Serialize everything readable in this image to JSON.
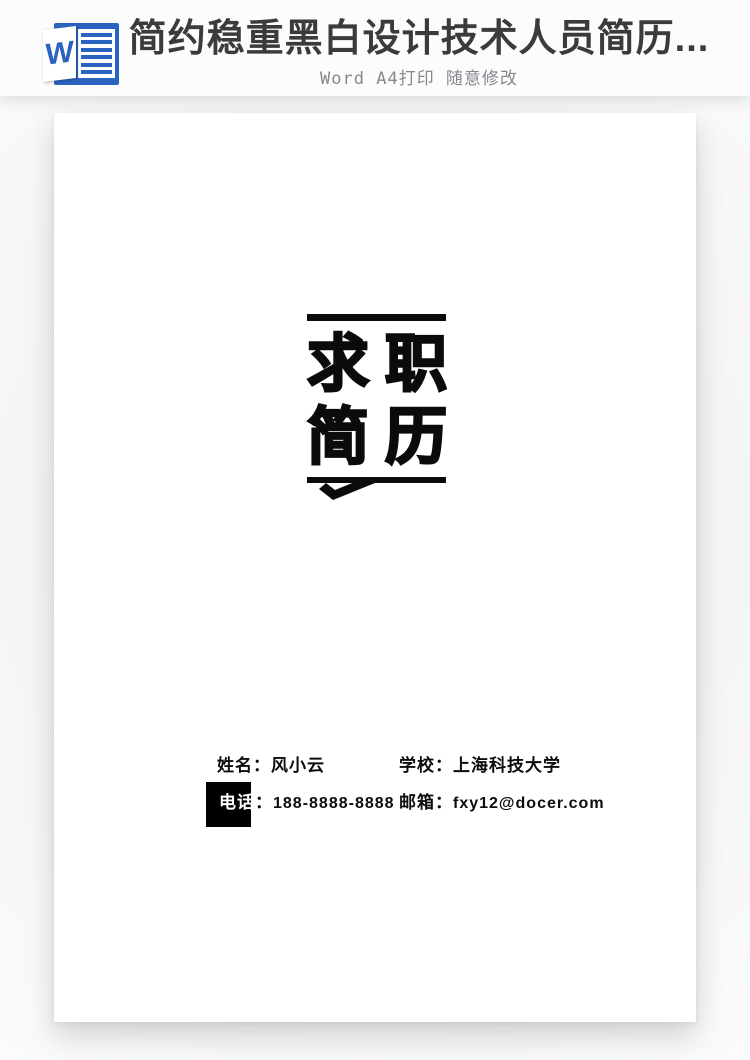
{
  "header": {
    "title": "简约稳重黑白设计技术人员简历...",
    "subtitle": "Word A4打印 随意修改",
    "word_icon_letter": "W"
  },
  "document": {
    "logo": {
      "chars": [
        [
          "求",
          "职"
        ],
        [
          "简",
          "历"
        ]
      ]
    },
    "contact": {
      "name_label": "姓名：",
      "name_value": "风小云",
      "school_label": "学校：",
      "school_value": "上海科技大学",
      "phone_label": "电话",
      "phone_colon": "：",
      "phone_value": "188-8888-8888",
      "email_label": "邮箱：",
      "email_value": "fxy12@docer.com"
    }
  },
  "colors": {
    "word_blue": "#2b63c1",
    "title_dark": "#3b3b3b",
    "subtitle_gray": "#85898d",
    "logo_black": "#0b0b0b",
    "page_white": "#ffffff"
  }
}
